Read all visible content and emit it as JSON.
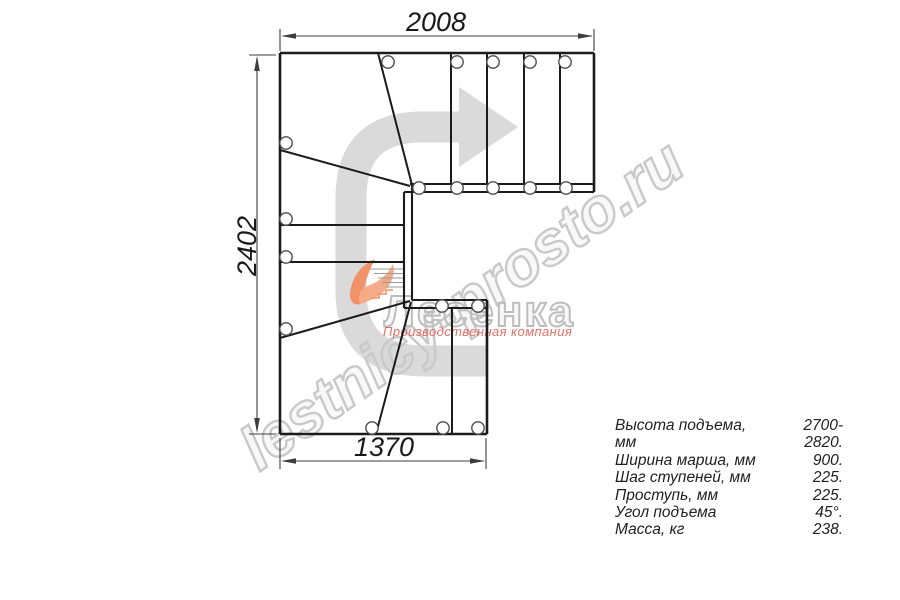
{
  "drawing": {
    "dimensions": {
      "top": "2008",
      "left": "2402",
      "bottom": "1370"
    }
  },
  "watermark": {
    "text": "lestnicy-prosto.ru"
  },
  "logo": {
    "name": "Лесенка",
    "subtitle": "Производственная компания"
  },
  "specs": {
    "rows": [
      {
        "label": "Высота подъема, мм",
        "value": "2700-2820."
      },
      {
        "label": "Ширина марша, мм",
        "value": "900."
      },
      {
        "label": "Шаг ступеней, мм",
        "value": "225."
      },
      {
        "label": "Проступь, мм",
        "value": "225."
      },
      {
        "label": "Угол подъема",
        "value": "45°."
      },
      {
        "label": "Масса, кг",
        "value": "238."
      }
    ]
  }
}
